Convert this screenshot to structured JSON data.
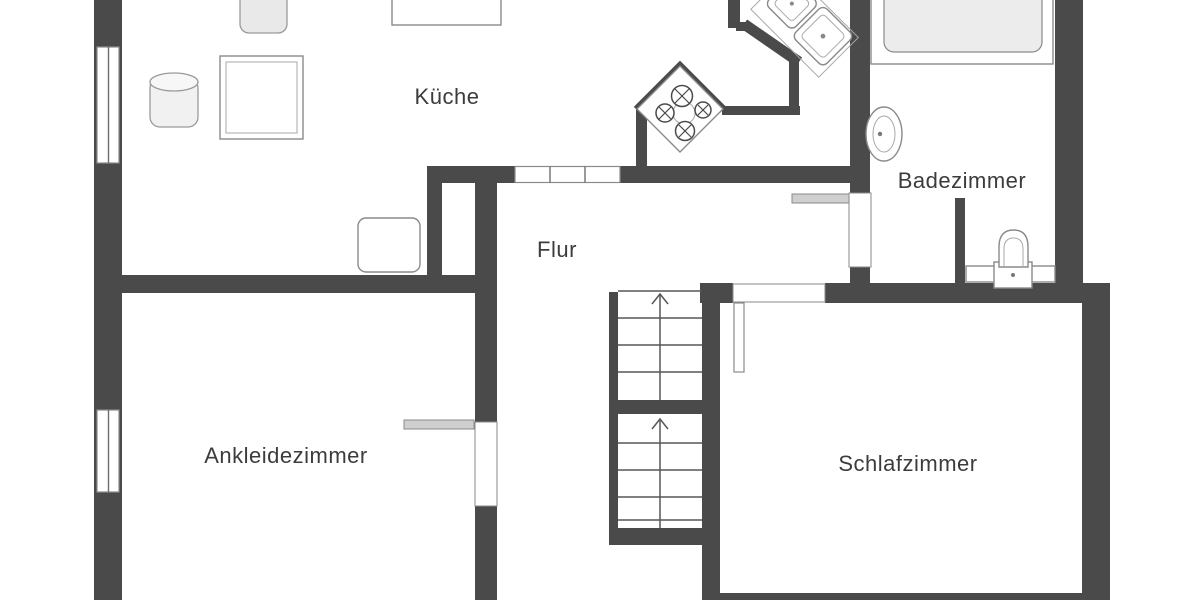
{
  "floorplan": {
    "rooms": {
      "kueche": {
        "label": "Küche"
      },
      "flur": {
        "label": "Flur"
      },
      "badezimmer": {
        "label": "Badezimmer"
      },
      "ankleidezimmer": {
        "label": "Ankleidezimmer"
      },
      "schlafzimmer": {
        "label": "Schlafzimmer"
      }
    },
    "doors": [
      "badezimmer-door",
      "schlafzimmer-door",
      "ankleidezimmer-door"
    ],
    "windows": [
      "kitchen-left-window",
      "ankleidezimmer-left-window",
      "flur-top-window"
    ],
    "stairs": {
      "flights": 2,
      "direction": "up"
    },
    "fixtures": [
      "bathtub",
      "toilet",
      "washbasin",
      "double-kitchen-sink",
      "corner-cooktop",
      "dining-table",
      "chair",
      "stool",
      "side-table",
      "counter-table"
    ],
    "colors": {
      "wall": "#4a4a4a",
      "outline": "#8a8a8a",
      "light_fill": "#ececec",
      "door_leaf": "#cfcfcf",
      "arc": "#555555",
      "text": "#3c3c3c",
      "background": "#ffffff"
    }
  }
}
